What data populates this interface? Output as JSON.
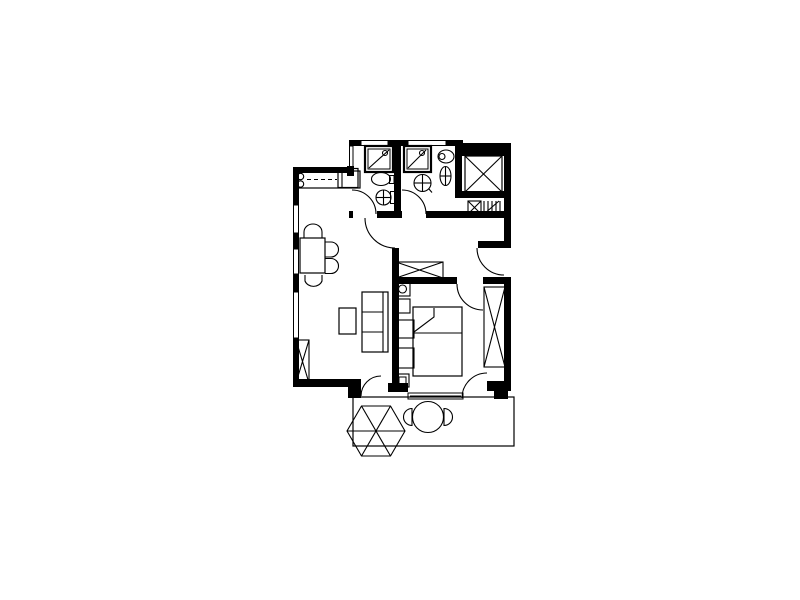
{
  "page": {
    "background": "#ffffff",
    "ink": "#000000"
  },
  "plan": {
    "elements": [
      {
        "name": "terrace-outline",
        "kind": "rect",
        "x": 353,
        "y": 397,
        "w": 161,
        "h": 49,
        "sw": 1.2
      },
      {
        "name": "parasol-canopy",
        "kind": "polygon",
        "pts": "405,431 390.5,406 361.5,406 347,431 361.5,456 390.5,456"
      },
      {
        "name": "parasol-rib-1",
        "kind": "line",
        "x1": 347,
        "y1": 431,
        "x2": 405,
        "y2": 431
      },
      {
        "name": "parasol-rib-2",
        "kind": "line",
        "x1": 361.5,
        "y1": 406,
        "x2": 390.5,
        "y2": 456
      },
      {
        "name": "parasol-rib-3",
        "kind": "line",
        "x1": 390.5,
        "y1": 406,
        "x2": 361.5,
        "y2": 456
      },
      {
        "name": "terrace-table",
        "kind": "circle",
        "cx": 428,
        "cy": 417,
        "r": 15.5
      },
      {
        "name": "terrace-chair-left",
        "kind": "path",
        "d": "M 412,408.5 A 8.5,8.5 0 0 0 412,425.5 Z"
      },
      {
        "name": "terrace-chair-right",
        "kind": "path",
        "d": "M 444,408.5 A 8.5,8.5 0 0 1 444,425.5 Z"
      },
      {
        "name": "window-left-1",
        "kind": "rect",
        "x": 293.5,
        "y": 205,
        "w": 5,
        "h": 28,
        "sw": 1
      },
      {
        "name": "window-left-2",
        "kind": "rect",
        "x": 293.5,
        "y": 249,
        "w": 5,
        "h": 25,
        "sw": 1
      },
      {
        "name": "window-left-3",
        "kind": "rect",
        "x": 293.5,
        "y": 292,
        "w": 5,
        "h": 46,
        "sw": 1
      },
      {
        "name": "window-bathroom-1",
        "kind": "rect",
        "x": 361,
        "y": 140.5,
        "w": 27,
        "h": 5,
        "sw": 1
      },
      {
        "name": "window-bathroom-2",
        "kind": "rect",
        "x": 408,
        "y": 140.5,
        "w": 38,
        "h": 5,
        "sw": 1
      },
      {
        "name": "patio-slider-window",
        "kind": "rect",
        "x": 408,
        "y": 393,
        "w": 55,
        "h": 6,
        "sw": 1
      },
      {
        "name": "patio-slider-rail",
        "kind": "line",
        "x1": 410,
        "y1": 396,
        "x2": 461,
        "y2": 396
      },
      {
        "name": "wall-left-a",
        "kind": "rect",
        "x": 293,
        "y": 167,
        "w": 6,
        "h": 38,
        "solid": true
      },
      {
        "name": "wall-left-b",
        "kind": "rect",
        "x": 293,
        "y": 233,
        "w": 6,
        "h": 16,
        "solid": true
      },
      {
        "name": "wall-left-c",
        "kind": "rect",
        "x": 293,
        "y": 274,
        "w": 6,
        "h": 18,
        "solid": true
      },
      {
        "name": "wall-left-d",
        "kind": "rect",
        "x": 293,
        "y": 338,
        "w": 6,
        "h": 48,
        "solid": true
      },
      {
        "name": "wall-kitchen-top",
        "kind": "rect",
        "x": 293,
        "y": 167,
        "w": 59,
        "h": 6,
        "solid": true
      },
      {
        "name": "wall-bath1-corner",
        "kind": "rect",
        "x": 347,
        "y": 166,
        "w": 7,
        "h": 10,
        "solid": true
      },
      {
        "name": "wall-bath1-exterior",
        "kind": "rect",
        "x": 349.5,
        "y": 146,
        "w": 3.5,
        "h": 21,
        "sw": 1
      },
      {
        "name": "wall-bath-top-a",
        "kind": "rect",
        "x": 349,
        "y": 140,
        "w": 12,
        "h": 6,
        "solid": true
      },
      {
        "name": "wall-bath-top-b",
        "kind": "rect",
        "x": 388,
        "y": 140,
        "w": 20,
        "h": 6,
        "solid": true
      },
      {
        "name": "wall-bath-top-c",
        "kind": "rect",
        "x": 446,
        "y": 140,
        "w": 17,
        "h": 6,
        "solid": true
      },
      {
        "name": "wall-shaft-top",
        "kind": "rect",
        "x": 461,
        "y": 143,
        "w": 50,
        "h": 13,
        "solid": true
      },
      {
        "name": "wall-bath-divider",
        "kind": "rect",
        "x": 394,
        "y": 140,
        "w": 7,
        "h": 78,
        "solid": true
      },
      {
        "name": "wall-bath2-right",
        "kind": "rect",
        "x": 455,
        "y": 140,
        "w": 7,
        "h": 58,
        "solid": true
      },
      {
        "name": "wall-right-upper",
        "kind": "rect",
        "x": 504,
        "y": 146,
        "w": 7,
        "h": 102,
        "solid": true
      },
      {
        "name": "wall-shaft-bottom",
        "kind": "rect",
        "x": 455,
        "y": 191,
        "w": 56,
        "h": 7,
        "solid": true
      },
      {
        "name": "wall-hall-top-a",
        "kind": "rect",
        "x": 349,
        "y": 211,
        "w": 4,
        "h": 7,
        "solid": true
      },
      {
        "name": "wall-hall-top-b",
        "kind": "rect",
        "x": 377,
        "y": 211,
        "w": 25,
        "h": 7,
        "solid": true
      },
      {
        "name": "wall-hall-top-c",
        "kind": "rect",
        "x": 426,
        "y": 211,
        "w": 85,
        "h": 7,
        "solid": true
      },
      {
        "name": "wall-entry-stub",
        "kind": "rect",
        "x": 478,
        "y": 241,
        "w": 26,
        "h": 7,
        "solid": true
      },
      {
        "name": "wall-living-bedroom",
        "kind": "rect",
        "x": 392,
        "y": 248,
        "w": 7,
        "h": 138,
        "solid": true
      },
      {
        "name": "wall-bedroom-top-a",
        "kind": "rect",
        "x": 399,
        "y": 277,
        "w": 58,
        "h": 7,
        "solid": true
      },
      {
        "name": "wall-bedroom-top-b",
        "kind": "rect",
        "x": 483,
        "y": 277,
        "w": 28,
        "h": 7,
        "solid": true
      },
      {
        "name": "wall-right-lower",
        "kind": "rect",
        "x": 504,
        "y": 277,
        "w": 7,
        "h": 114,
        "solid": true
      },
      {
        "name": "wall-bedroom-bottom",
        "kind": "rect",
        "x": 388,
        "y": 383,
        "w": 20,
        "h": 9,
        "solid": true
      },
      {
        "name": "wall-bedroom-bottom-corner-a",
        "kind": "rect",
        "x": 487,
        "y": 381,
        "w": 20,
        "h": 10,
        "solid": true
      },
      {
        "name": "wall-bedroom-bottom-corner-b",
        "kind": "rect",
        "x": 494,
        "y": 388,
        "w": 14,
        "h": 11,
        "solid": true
      },
      {
        "name": "wall-living-bottom",
        "kind": "rect",
        "x": 293,
        "y": 379,
        "w": 59,
        "h": 8,
        "solid": true
      },
      {
        "name": "wall-terrace-step",
        "kind": "rect",
        "x": 348,
        "y": 379,
        "w": 13,
        "h": 19,
        "solid": true
      },
      {
        "name": "door-arc-bathroom-1",
        "kind": "path",
        "d": "M 352,190 A 24,24 0 0 1 376,214"
      },
      {
        "name": "door-arc-bathroom-2",
        "kind": "path",
        "d": "M 402,190 A 24,24 0 0 1 426,214"
      },
      {
        "name": "door-arc-living-room",
        "kind": "path",
        "d": "M 365,218 A 30,30 0 0 0 395,248"
      },
      {
        "name": "door-arc-entry",
        "kind": "path",
        "d": "M 477,248 A 27,27 0 0 0 504,275"
      },
      {
        "name": "door-arc-bedroom",
        "kind": "path",
        "d": "M 457,284 A 26,26 0 0 0 483,310"
      },
      {
        "name": "door-arc-bedroom-terrace",
        "kind": "path",
        "d": "M 462,398 A 25,25 0 0 1 487,373"
      },
      {
        "name": "door-arc-living-terrace",
        "kind": "path",
        "d": "M 361,396 A 20,20 0 0 1 381,376"
      },
      {
        "name": "kitchen-counter",
        "kind": "rect",
        "x": 296,
        "y": 171,
        "w": 64,
        "h": 17,
        "sw": 1.2
      },
      {
        "name": "kitchen-burner-1",
        "kind": "circle",
        "cx": 300.5,
        "cy": 176.5,
        "r": 3.2
      },
      {
        "name": "kitchen-burner-2",
        "kind": "circle",
        "cx": 300.5,
        "cy": 184,
        "r": 3.2
      },
      {
        "name": "kitchen-counter-dash",
        "kind": "line",
        "x1": 307,
        "y1": 179.5,
        "x2": 337,
        "y2": 179.5,
        "dash": true
      },
      {
        "name": "kitchen-sink",
        "kind": "rect",
        "x": 338,
        "y": 168.5,
        "w": 20,
        "h": 19,
        "sw": 1.2
      },
      {
        "name": "kitchen-sink-divider",
        "kind": "line",
        "x1": 342,
        "y1": 168.5,
        "x2": 342,
        "y2": 187.5
      },
      {
        "name": "dining-table",
        "kind": "rect",
        "x": 300,
        "y": 238,
        "w": 25,
        "h": 35,
        "sw": 1.2
      },
      {
        "name": "dining-chair-top",
        "kind": "path",
        "d": "M 304,238 V 232 A 9,8 0 0 1 322,232 V 238"
      },
      {
        "name": "dining-chair-right-1",
        "kind": "path",
        "d": "M 325,242 H 331 A 7.5,7.5 0 0 1 331,257 H 325"
      },
      {
        "name": "dining-chair-right-2",
        "kind": "path",
        "d": "M 325,258.5 H 331 A 7.5,7.5 0 0 1 331,273.5 H 325"
      },
      {
        "name": "dining-chair-bottom",
        "kind": "path",
        "d": "M 305,275 V 281 A 9,8 0 0 0 322,281 V 275"
      },
      {
        "name": "coffee-table",
        "kind": "rect",
        "x": 339,
        "y": 308,
        "w": 17,
        "h": 26,
        "sw": 1.2
      },
      {
        "name": "sofa-outline",
        "kind": "rect",
        "x": 362,
        "y": 292,
        "w": 26,
        "h": 60,
        "sw": 1.2
      },
      {
        "name": "sofa-back-line",
        "kind": "line",
        "x1": 383,
        "y1": 292,
        "x2": 383,
        "y2": 352
      },
      {
        "name": "sofa-cushion-divider-1",
        "kind": "line",
        "x1": 362,
        "y1": 312,
        "x2": 383,
        "y2": 312
      },
      {
        "name": "sofa-cushion-divider-2",
        "kind": "line",
        "x1": 362,
        "y1": 332,
        "x2": 383,
        "y2": 332
      },
      {
        "name": "living-radiator",
        "kind": "rect",
        "x": 296,
        "y": 340,
        "w": 13,
        "h": 43,
        "sw": 1.1
      },
      {
        "name": "living-radiator-x1",
        "kind": "line",
        "x1": 296,
        "y1": 340,
        "x2": 309,
        "y2": 383
      },
      {
        "name": "living-radiator-x2",
        "kind": "line",
        "x1": 309,
        "y1": 340,
        "x2": 296,
        "y2": 383
      },
      {
        "name": "hall-wardrobe",
        "kind": "rect",
        "x": 396,
        "y": 262,
        "w": 47,
        "h": 16,
        "sw": 1.1
      },
      {
        "name": "hall-wardrobe-x1",
        "kind": "line",
        "x1": 396,
        "y1": 262,
        "x2": 443,
        "y2": 278
      },
      {
        "name": "hall-wardrobe-x2",
        "kind": "line",
        "x1": 443,
        "y1": 262,
        "x2": 396,
        "y2": 278
      },
      {
        "name": "nightstand-lamp-table",
        "kind": "rect",
        "x": 395,
        "y": 282,
        "w": 15,
        "h": 14,
        "sw": 1.1
      },
      {
        "name": "nightstand-lamp",
        "kind": "circle",
        "cx": 402.5,
        "cy": 289,
        "r": 4
      },
      {
        "name": "nightstand-2",
        "kind": "rect",
        "x": 395,
        "y": 299,
        "w": 15,
        "h": 14,
        "sw": 1.1
      },
      {
        "name": "bed",
        "kind": "rect",
        "x": 413,
        "y": 307,
        "w": 49,
        "h": 69,
        "sw": 1.2
      },
      {
        "name": "bed-blanket-line",
        "kind": "line",
        "x1": 413,
        "y1": 333,
        "x2": 462,
        "y2": 333
      },
      {
        "name": "bed-fold",
        "kind": "path",
        "d": "M 434,308 L 434,317 L 414,332"
      },
      {
        "name": "bed-side-table-1",
        "kind": "rect",
        "x": 398,
        "y": 320,
        "w": 16,
        "h": 18,
        "sw": 1.1
      },
      {
        "name": "bed-side-table-2",
        "kind": "rect",
        "x": 398,
        "y": 348,
        "w": 16,
        "h": 20,
        "sw": 1.1
      },
      {
        "name": "bedroom-stool",
        "kind": "rect",
        "x": 396,
        "y": 374,
        "w": 13,
        "h": 13,
        "sw": 1.1
      },
      {
        "name": "bedroom-stool-inner",
        "kind": "rect",
        "x": 399,
        "y": 377,
        "w": 7,
        "h": 7,
        "sw": 1
      },
      {
        "name": "bedroom-wardrobe",
        "kind": "rect",
        "x": 484,
        "y": 287,
        "w": 21,
        "h": 80,
        "sw": 1.1
      },
      {
        "name": "bedroom-wardrobe-x1",
        "kind": "line",
        "x1": 484,
        "y1": 287,
        "x2": 505,
        "y2": 367
      },
      {
        "name": "bedroom-wardrobe-x2",
        "kind": "line",
        "x1": 505,
        "y1": 287,
        "x2": 484,
        "y2": 367
      },
      {
        "name": "elevator-shaft",
        "kind": "rect",
        "x": 465,
        "y": 156,
        "w": 37,
        "h": 36,
        "sw": 1.2
      },
      {
        "name": "elevator-shaft-x1",
        "kind": "line",
        "x1": 465,
        "y1": 156,
        "x2": 502,
        "y2": 192
      },
      {
        "name": "elevator-shaft-x2",
        "kind": "line",
        "x1": 502,
        "y1": 156,
        "x2": 465,
        "y2": 192
      },
      {
        "name": "duct-box",
        "kind": "rect",
        "x": 468,
        "y": 201,
        "w": 13,
        "h": 13,
        "sw": 1.1
      },
      {
        "name": "duct-box-x1",
        "kind": "line",
        "x1": 468,
        "y1": 201,
        "x2": 481,
        "y2": 214
      },
      {
        "name": "duct-box-x2",
        "kind": "line",
        "x1": 481,
        "y1": 201,
        "x2": 468,
        "y2": 214
      },
      {
        "name": "vent-fin-1",
        "kind": "line",
        "x1": 484,
        "y1": 201,
        "x2": 484,
        "y2": 214
      },
      {
        "name": "vent-fin-2",
        "kind": "line",
        "x1": 488,
        "y1": 201,
        "x2": 488,
        "y2": 214
      },
      {
        "name": "vent-fin-3",
        "kind": "line",
        "x1": 492,
        "y1": 201,
        "x2": 492,
        "y2": 214
      },
      {
        "name": "vent-fin-4",
        "kind": "line",
        "x1": 496,
        "y1": 201,
        "x2": 496,
        "y2": 214
      },
      {
        "name": "vent-fin-5",
        "kind": "line",
        "x1": 500,
        "y1": 201,
        "x2": 500,
        "y2": 214
      },
      {
        "name": "vent-diagonal",
        "kind": "line",
        "x1": 484,
        "y1": 214,
        "x2": 499,
        "y2": 201
      },
      {
        "name": "shower-1-outer",
        "kind": "rect",
        "x": 365,
        "y": 146,
        "w": 28,
        "h": 26,
        "sw": 2.2
      },
      {
        "name": "shower-1-inner",
        "kind": "rect",
        "x": 368,
        "y": 149,
        "w": 22,
        "h": 20,
        "sw": 1
      },
      {
        "name": "shower-1-diagonal",
        "kind": "line",
        "x1": 369,
        "y1": 168,
        "x2": 389,
        "y2": 150
      },
      {
        "name": "shower-1-head",
        "kind": "circle",
        "cx": 385,
        "cy": 153,
        "r": 2.5
      },
      {
        "name": "sink-1-basin",
        "kind": "ellipse",
        "cx": 381,
        "cy": 179,
        "rx": 9.5,
        "ry": 6.5
      },
      {
        "name": "sink-1-tap",
        "kind": "rect",
        "x": 389.5,
        "y": 175.5,
        "w": 4.5,
        "h": 8,
        "sw": 1
      },
      {
        "name": "toilet-1-bowl",
        "kind": "circle",
        "cx": 383.5,
        "cy": 197.5,
        "r": 7.5
      },
      {
        "name": "toilet-1-cross-v",
        "kind": "line",
        "x1": 383.5,
        "y1": 190.5,
        "x2": 383.5,
        "y2": 204.5
      },
      {
        "name": "toilet-1-cross-h",
        "kind": "line",
        "x1": 376.5,
        "y1": 197.5,
        "x2": 390.5,
        "y2": 197.5
      },
      {
        "name": "toilet-1-tank",
        "kind": "rect",
        "x": 390.5,
        "y": 191.5,
        "w": 4.5,
        "h": 12,
        "sw": 1
      },
      {
        "name": "shower-2-outer",
        "kind": "rect",
        "x": 404,
        "y": 146,
        "w": 27,
        "h": 26,
        "sw": 2.2
      },
      {
        "name": "shower-2-inner",
        "kind": "rect",
        "x": 407,
        "y": 149,
        "w": 21,
        "h": 20,
        "sw": 1
      },
      {
        "name": "shower-2-diagonal",
        "kind": "line",
        "x1": 408,
        "y1": 168,
        "x2": 426,
        "y2": 150
      },
      {
        "name": "shower-2-head",
        "kind": "circle",
        "cx": 422,
        "cy": 153,
        "r": 2.5
      },
      {
        "name": "toilet-2-bowl",
        "kind": "ellipse",
        "cx": 446,
        "cy": 156.5,
        "rx": 8,
        "ry": 6.5
      },
      {
        "name": "toilet-2-flush",
        "kind": "circle",
        "cx": 442,
        "cy": 156.5,
        "r": 3
      },
      {
        "name": "sink-2-basin",
        "kind": "circle",
        "cx": 422.5,
        "cy": 183,
        "r": 8.5
      },
      {
        "name": "sink-2-cross-v",
        "kind": "line",
        "x1": 422.5,
        "y1": 175,
        "x2": 422.5,
        "y2": 191
      },
      {
        "name": "sink-2-cross-h",
        "kind": "line",
        "x1": 414.5,
        "y1": 183,
        "x2": 430.5,
        "y2": 183
      },
      {
        "name": "sink-2-tap",
        "kind": "line",
        "x1": 428.5,
        "y1": 188.5,
        "x2": 432,
        "y2": 192.5
      },
      {
        "name": "bidet-basin",
        "kind": "ellipse",
        "cx": 445.5,
        "cy": 176,
        "rx": 5.5,
        "ry": 9.5
      },
      {
        "name": "bidet-cross-v",
        "kind": "line",
        "x1": 445.5,
        "y1": 167,
        "x2": 445.5,
        "y2": 185
      },
      {
        "name": "bidet-cross-h",
        "kind": "line",
        "x1": 440.5,
        "y1": 176,
        "x2": 450.5,
        "y2": 176
      }
    ]
  }
}
